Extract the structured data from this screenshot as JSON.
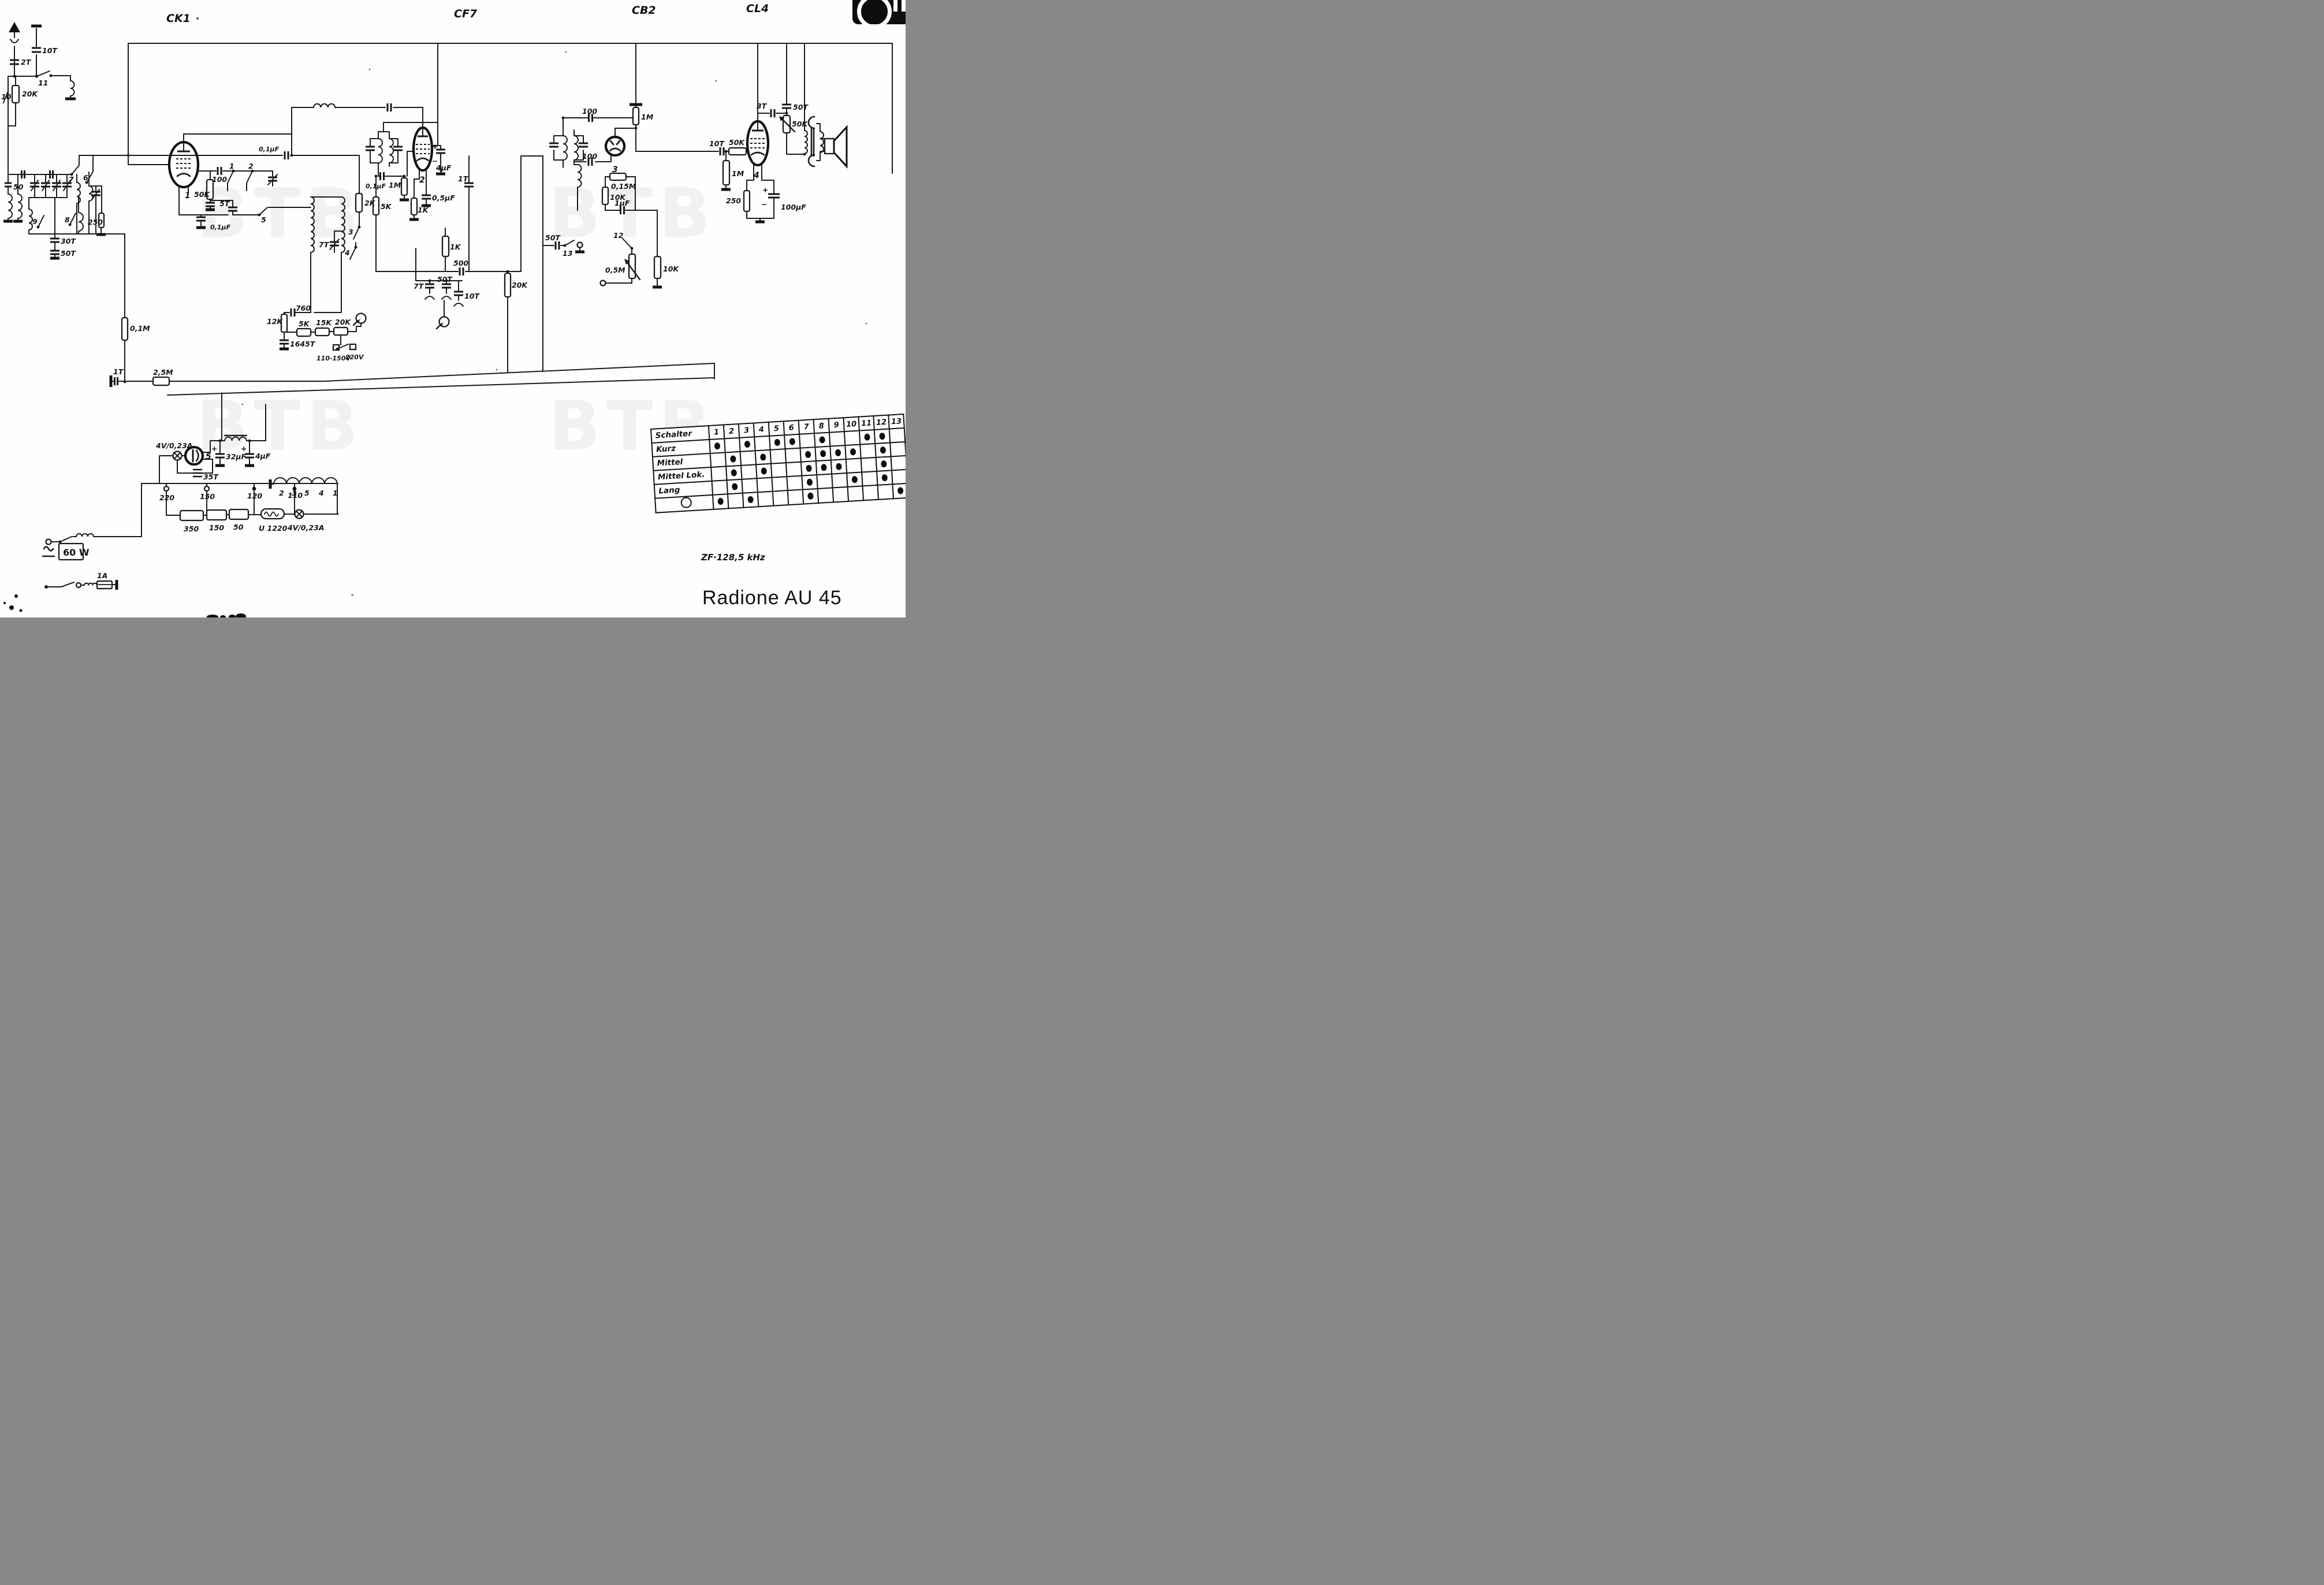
{
  "header": {
    "ck1": "CK1",
    "cf7": "CF7",
    "cb2": "CB2",
    "cl4": "CL4"
  },
  "title": "Radione AU 45",
  "if_frequency": "ZF·128,5 kHz",
  "watermark": "BTB",
  "tubes": {
    "t1": "1",
    "t2": "2",
    "t3": "3",
    "t4": "4",
    "t5": "5"
  },
  "labels": {
    "c10T_ant": "10T",
    "c2T": "2T",
    "sw11": "11",
    "sw10": "10",
    "r20K_ant": "20K",
    "c50": "50",
    "sw7": "7",
    "sw6": "6",
    "sw9": "9",
    "sw8": "8",
    "r250_rf": "250",
    "c30T": "30T",
    "c50T_rf": "50T",
    "r01M": "0,1M",
    "c1T_avc": "1T",
    "r25M": "2,5M",
    "r50K_osc": "50K",
    "c100_g1": "100",
    "sw1": "1",
    "sw2": "2",
    "sw5": "5",
    "c5T": "5T",
    "c01uF_k1": "0,1µF",
    "c7T_osc": "7T",
    "sw3": "3",
    "sw4": "4",
    "r12K": "12K",
    "c760": "760",
    "c1645T": "1645T",
    "r5K_pad": "5K",
    "r15K": "15K",
    "r20K_pad": "20K",
    "v110": "110-150V",
    "v220": "220V",
    "c01uF_hf": "0,1µF",
    "r2K": "2K",
    "r5K_g2": "5K",
    "c01uF_g2": "0,1µF",
    "r1M_g2": "1M",
    "c4uF_scr": "4µF",
    "plus1": "+",
    "minus1": "−",
    "r1K_k2": "1K",
    "c05uF": "0,5µF",
    "r1K_det": "1K",
    "c500": "500",
    "c50T_det": "50T",
    "c7T_det": "7T",
    "c10T_det": "10T",
    "c1T_cpl": "1T",
    "r20K_det": "20K",
    "c50T_ph": "50T",
    "sw13": "13",
    "c100_ifin": "100",
    "r1M_top": "1M",
    "c100_d": "100",
    "r015M": "0,15M",
    "r10K_a": "10K",
    "sw12": "12",
    "c1uF": "1µF",
    "r10K_b": "10K",
    "r05M": "0,5M",
    "c10T_af": "10T",
    "r50K_af": "50K",
    "r1M_af": "1M",
    "c3T": "3T",
    "c50T_tone": "50T",
    "r50K_tone": "50K",
    "r250_k4": "250",
    "c100uF": "100µF",
    "plus2": "+",
    "minus2": "−",
    "lamp_a": "4V/0,23A",
    "c35T": "35T",
    "c32uF": "32µF",
    "plus3": "+",
    "c4uF_ps": "4µF",
    "plus4": "+",
    "tap220": "220",
    "tap150": "150",
    "tap120": "120",
    "tap110": "110",
    "r350": "350",
    "r150": "150",
    "r50": "50",
    "barretter": "U 1220",
    "lamp_b": "4V/0,23A",
    "h2": "2",
    "h3": "3",
    "h5": "5",
    "h4": "4",
    "h1": "1",
    "fuse": "1A",
    "power": "60 W"
  },
  "table": {
    "header": "Schalter",
    "columns": [
      "1",
      "2",
      "3",
      "4",
      "5",
      "6",
      "7",
      "8",
      "9",
      "10",
      "11",
      "12",
      "13"
    ],
    "rows": [
      {
        "name": "Kurz",
        "phono": false,
        "dots": [
          1,
          3,
          5,
          6,
          8,
          11,
          12
        ]
      },
      {
        "name": "Mittel",
        "phono": false,
        "dots": [
          2,
          4,
          7,
          8,
          9,
          10,
          12
        ]
      },
      {
        "name": "Mittel Lok.",
        "phono": false,
        "dots": [
          2,
          4,
          7,
          8,
          9,
          12
        ]
      },
      {
        "name": "Lang",
        "phono": false,
        "dots": [
          2,
          7,
          10,
          12
        ]
      },
      {
        "name": "",
        "phono": true,
        "dots": [
          1,
          3,
          7,
          13
        ]
      }
    ]
  }
}
